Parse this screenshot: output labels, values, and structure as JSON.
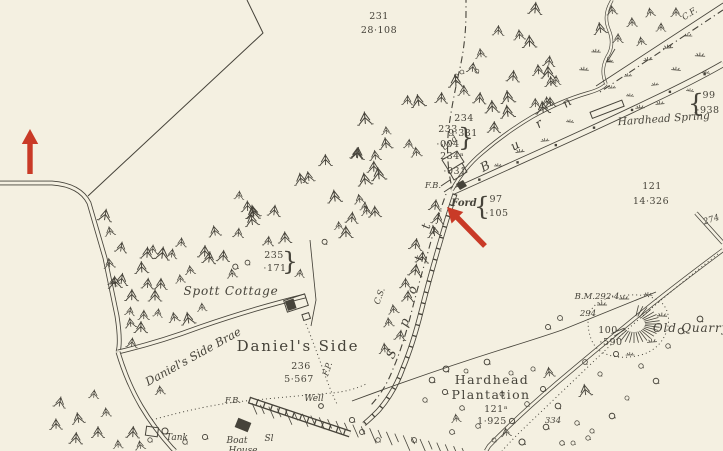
{
  "map": {
    "colors": {
      "paper": "#f4f0e1",
      "ink": "#46433a",
      "red": "#c93a27"
    },
    "labels": [
      {
        "t": "231",
        "x": 379,
        "y": 19,
        "c": "num"
      },
      {
        "t": "28·108",
        "x": 379,
        "y": 33,
        "c": "num"
      },
      {
        "t": "233",
        "x": 448,
        "y": 132,
        "c": "num"
      },
      {
        "t": "·004",
        "x": 448,
        "y": 147,
        "c": "num"
      },
      {
        "t": "}",
        "x": 466,
        "y": 146,
        "c": "brace"
      },
      {
        "t": "234",
        "x": 464,
        "y": 121,
        "c": "num"
      },
      {
        "t": "9·331",
        "x": 463,
        "y": 136,
        "c": "num"
      },
      {
        "t": "234ᵃ",
        "x": 452,
        "y": 159,
        "c": "num"
      },
      {
        "t": "·031",
        "x": 455,
        "y": 174,
        "c": "num"
      },
      {
        "t": "97",
        "x": 496,
        "y": 202,
        "c": "num"
      },
      {
        "t": "·105",
        "x": 497,
        "y": 216,
        "c": "num"
      },
      {
        "t": "{",
        "x": 482,
        "y": 215,
        "c": "brace"
      },
      {
        "t": "99",
        "x": 709,
        "y": 98,
        "c": "num"
      },
      {
        "t": "·938",
        "x": 708,
        "y": 113,
        "c": "num"
      },
      {
        "t": "{",
        "x": 696,
        "y": 112,
        "c": "brace"
      },
      {
        "t": "121",
        "x": 652,
        "y": 189,
        "c": "num"
      },
      {
        "t": "14·326",
        "x": 651,
        "y": 204,
        "c": "num"
      },
      {
        "t": "B.M.292·4",
        "x": 597,
        "y": 299,
        "c": "abbr"
      },
      {
        "t": "294",
        "x": 588,
        "y": 316,
        "c": "num-it"
      },
      {
        "t": "100",
        "x": 608,
        "y": 333,
        "c": "num"
      },
      {
        "t": "·590",
        "x": 611,
        "y": 345,
        "c": "num"
      },
      {
        "t": "235",
        "x": 274,
        "y": 258,
        "c": "num"
      },
      {
        "t": "·171",
        "x": 275,
        "y": 271,
        "c": "num"
      },
      {
        "t": "}",
        "x": 290,
        "y": 270,
        "c": "brace"
      },
      {
        "t": "236",
        "x": 301,
        "y": 369,
        "c": "num"
      },
      {
        "t": "5·567",
        "x": 299,
        "y": 382,
        "c": "num"
      },
      {
        "t": "121ᵃ",
        "x": 496,
        "y": 412,
        "c": "num"
      },
      {
        "t": "1·925",
        "x": 492,
        "y": 424,
        "c": "num"
      },
      {
        "t": "334",
        "x": 553,
        "y": 423,
        "c": "num-it"
      },
      {
        "t": "274",
        "x": 712,
        "y": 222,
        "c": "num-it",
        "r": -18
      },
      {
        "t": "Hardhead Spring",
        "x": 664,
        "y": 122,
        "c": "name-i",
        "r": -4
      },
      {
        "t": "Ford",
        "x": 464,
        "y": 206,
        "c": "name-ford"
      },
      {
        "t": "Spott Cottage",
        "x": 231,
        "y": 295,
        "c": "name-i-lg"
      },
      {
        "t": "Old Quarry",
        "x": 691,
        "y": 332,
        "c": "name-i-lg"
      },
      {
        "t": "Tank",
        "x": 177,
        "y": 440,
        "c": "name-i-sm"
      },
      {
        "t": "Boat",
        "x": 237,
        "y": 443,
        "c": "name-i-sm"
      },
      {
        "t": "House",
        "x": 243,
        "y": 453,
        "c": "name-i-sm"
      },
      {
        "t": "Sl",
        "x": 269,
        "y": 441,
        "c": "name-i-sm"
      },
      {
        "t": "Well",
        "x": 314,
        "y": 401,
        "c": "name-i-sm"
      },
      {
        "t": "F.B.",
        "x": 433,
        "y": 188,
        "c": "abbr"
      },
      {
        "t": "F.B.",
        "x": 233,
        "y": 403,
        "c": "abbr"
      },
      {
        "t": "F.P.",
        "x": 330,
        "y": 370,
        "c": "abbr",
        "r": -72
      },
      {
        "t": "Und",
        "x": 451,
        "y": 145,
        "c": "abbr",
        "r": -40
      },
      {
        "t": "C.F.",
        "x": 691,
        "y": 16,
        "c": "abbr",
        "r": -33
      },
      {
        "t": "C.S.",
        "x": 382,
        "y": 297,
        "c": "abbr",
        "r": -70
      },
      {
        "t": "Daniel's Side Brae",
        "x": 195,
        "y": 360,
        "c": "name-i-md",
        "r": -29
      },
      {
        "t": "Daniel's Side",
        "x": 298,
        "y": 351,
        "c": "name-rm-lg"
      },
      {
        "t": "Hardhead",
        "x": 492,
        "y": 384,
        "c": "name-rm-md"
      },
      {
        "t": "Plantation",
        "x": 491,
        "y": 399,
        "c": "name-rm-md"
      },
      {
        "t": "B",
        "x": 487,
        "y": 170,
        "c": "letter",
        "r": -28
      },
      {
        "t": "u",
        "x": 517,
        "y": 149,
        "c": "letter",
        "r": -30
      },
      {
        "t": "r",
        "x": 541,
        "y": 127,
        "c": "letter",
        "r": -33
      },
      {
        "t": "n",
        "x": 569,
        "y": 106,
        "c": "letter",
        "r": -35
      },
      {
        "t": "S",
        "x": 395,
        "y": 356,
        "c": "letter",
        "r": -62
      },
      {
        "t": "p",
        "x": 408,
        "y": 324,
        "c": "letter",
        "r": -68
      },
      {
        "t": "o",
        "x": 416,
        "y": 291,
        "c": "letter",
        "r": -74
      },
      {
        "t": "t",
        "x": 423,
        "y": 259,
        "c": "letter",
        "r": -78
      },
      {
        "t": "t",
        "x": 430,
        "y": 227,
        "c": "letter",
        "r": -78
      }
    ],
    "arrows": [
      {
        "name": "annotation-arrow-left",
        "tail": [
          30,
          174
        ],
        "tip": [
          30,
          129
        ]
      },
      {
        "name": "annotation-arrow-ford",
        "tail": [
          485,
          246
        ],
        "tip": [
          447,
          207
        ]
      }
    ]
  }
}
